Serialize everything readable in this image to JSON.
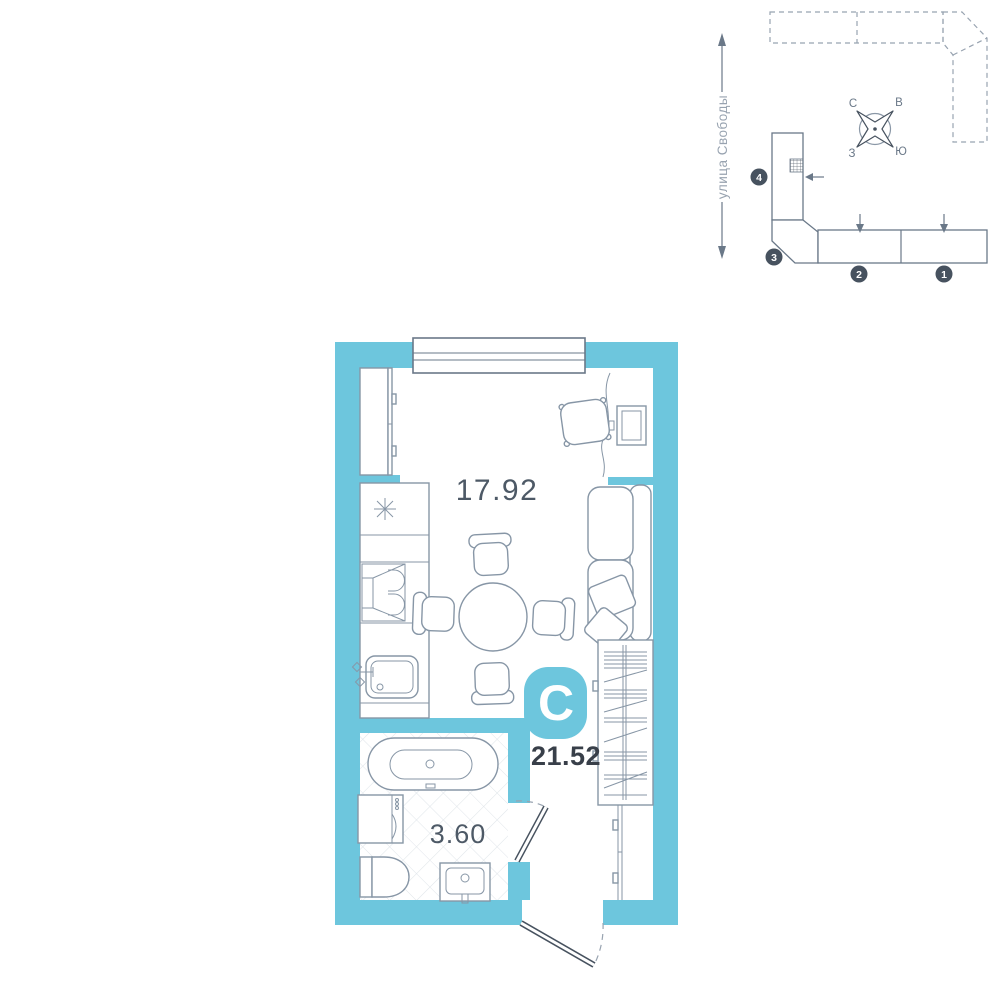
{
  "site_plan": {
    "street_label": "улица Свободы",
    "compass": {
      "north": "С",
      "east": "В",
      "west": "З",
      "south": "Ю"
    },
    "sections": [
      {
        "number": "1"
      },
      {
        "number": "2"
      },
      {
        "number": "3"
      },
      {
        "number": "4"
      }
    ]
  },
  "floor_plan": {
    "type_badge": "С",
    "total_area": "21.52",
    "living_area": "17.92",
    "bathroom_area": "3.60"
  },
  "colors": {
    "wall": "#6dc6dd",
    "line": "#8796a6",
    "site-line": "#6a7888",
    "dash": "#98a3b0",
    "accent-dark": "#47525f",
    "text-light": "#4d5966",
    "text-dark": "#383f49"
  }
}
